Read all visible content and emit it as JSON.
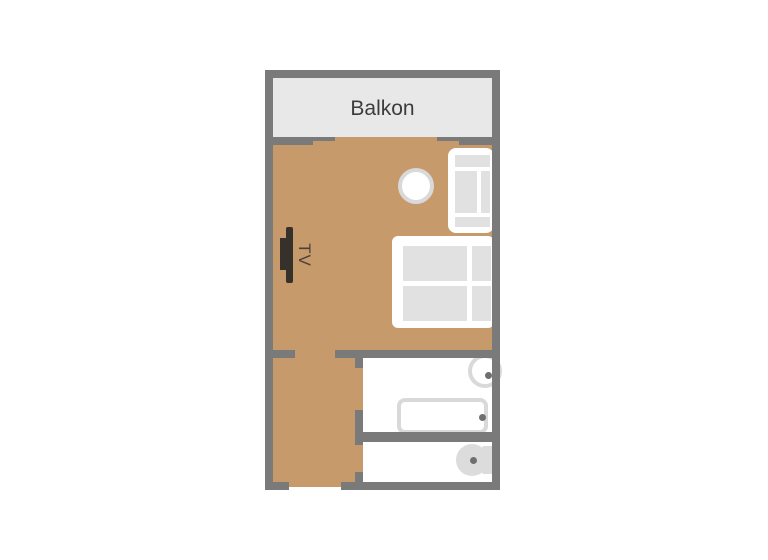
{
  "plan": {
    "labels": {
      "balcony": "Balkon",
      "tv": "TV"
    },
    "rooms": [
      {
        "name": "balcony",
        "label": "Balkon"
      },
      {
        "name": "living-room",
        "label": ""
      },
      {
        "name": "hallway",
        "label": ""
      },
      {
        "name": "bathroom-upper",
        "label": ""
      },
      {
        "name": "bathroom-lower",
        "label": ""
      }
    ],
    "furniture": [
      "tv",
      "round-table",
      "armchair",
      "double-bed",
      "sink",
      "bathtub",
      "toilet"
    ],
    "colors": {
      "wall": "#7a7a7a",
      "floor": "#c79a6b",
      "balcony": "#e8e8e8",
      "cushion": "#e1e1e1",
      "fixture": "#d9d9d9",
      "toilet": "#dcdcdc",
      "dot": "#6f6f6f",
      "tv": "#36312b",
      "tvtext": "#4a4238",
      "label": "#3c3c3c"
    }
  }
}
